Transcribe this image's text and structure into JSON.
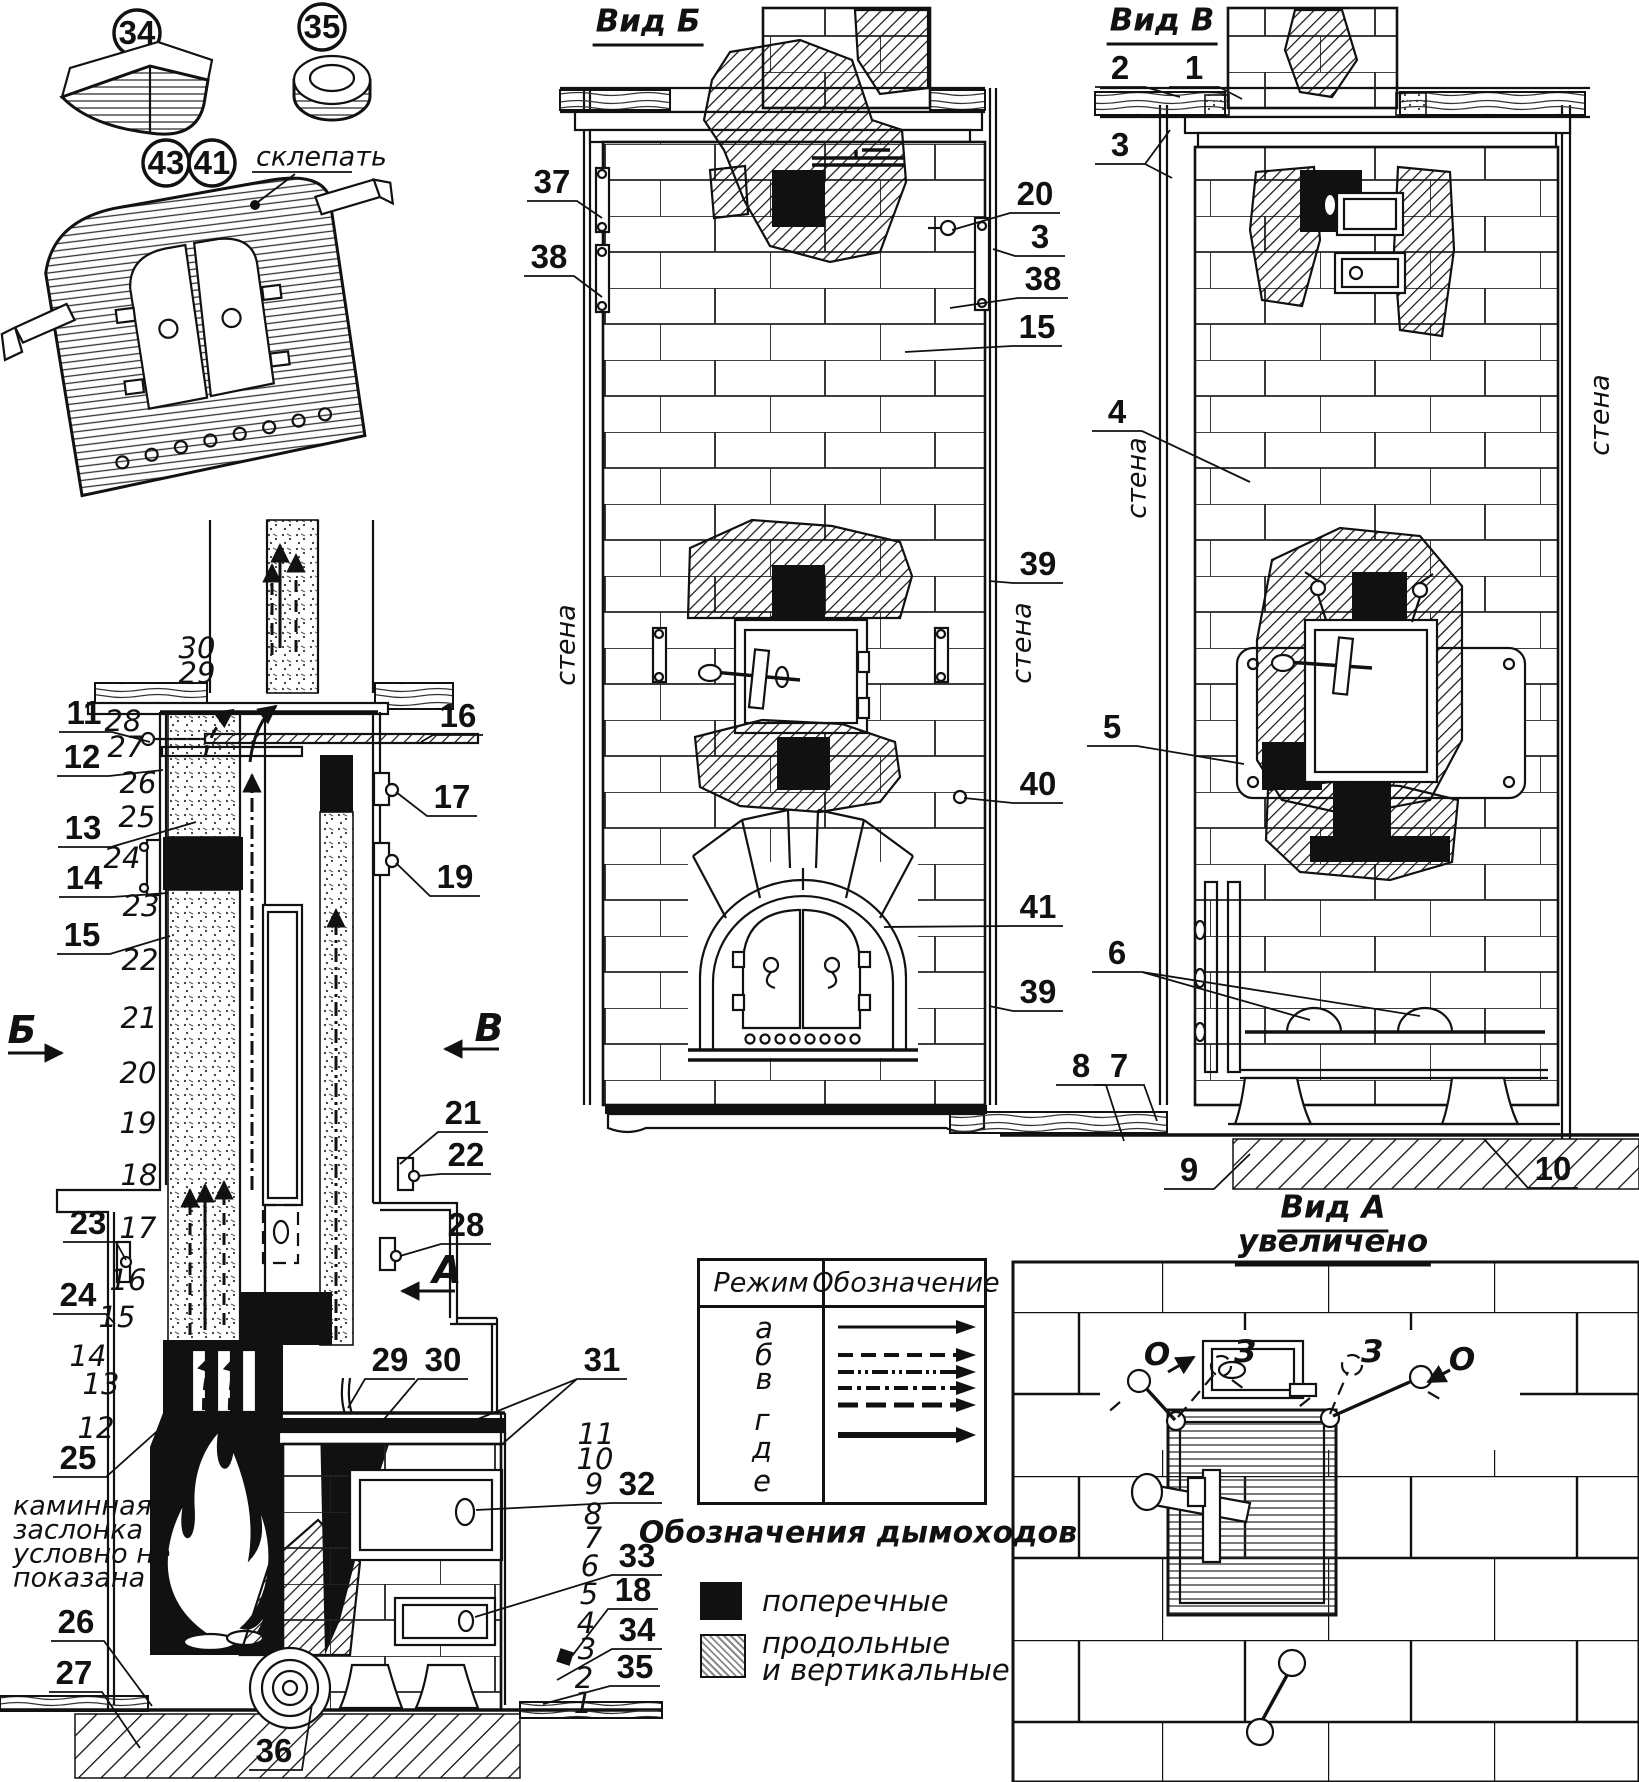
{
  "parts_detail": {
    "circle_34": "34",
    "circle_35": "35",
    "circle_43": "43",
    "circle_41": "41",
    "rivet_label": "склепать"
  },
  "section": {
    "dir_b": "Б",
    "dir_v": "В",
    "dir_a": "А",
    "note_line1": "каминная",
    "note_line2": "заслонка",
    "note_line3": "условно не",
    "note_line4": "показана",
    "rows_left": [
      "30",
      "29",
      "28",
      "27",
      "26",
      "25",
      "24",
      "23",
      "22",
      "21",
      "20",
      "19",
      "18",
      "17",
      "16",
      "15",
      "14",
      "13",
      "12"
    ],
    "rows_right": [
      "11",
      "10",
      "9",
      "8",
      "7",
      "6",
      "5",
      "4",
      "3",
      "2",
      "1"
    ],
    "callouts_left": [
      "11",
      "12",
      "13",
      "14",
      "15",
      "23",
      "24",
      "25",
      "26",
      "27"
    ],
    "callouts_right": [
      "16",
      "17",
      "19",
      "21",
      "22",
      "28",
      "29",
      "30",
      "31",
      "32",
      "33",
      "18",
      "34",
      "35"
    ],
    "callout_36": "36"
  },
  "vid_b": {
    "title": "Вид Б",
    "wall_left": "стена",
    "wall_right": "стена",
    "callouts_left": [
      "37",
      "38"
    ],
    "callouts_right": [
      "20",
      "3",
      "38",
      "15",
      "39",
      "40",
      "41",
      "39"
    ]
  },
  "vid_v": {
    "title": "Вид В",
    "wall_left": "стена",
    "wall_right": "стена",
    "callouts": [
      "2",
      "1",
      "3",
      "4",
      "5",
      "6",
      "8",
      "7",
      "9",
      "10"
    ]
  },
  "vid_a": {
    "title": "Вид А",
    "subtitle": "увеличено",
    "open_left": "О",
    "closed_left": "З",
    "closed_right": "З",
    "open_right": "О"
  },
  "legend_table": {
    "header_mode": "Режим",
    "header_symbol": "Обозначение",
    "rows": [
      {
        "mode": "а",
        "styles": [
          "solid"
        ]
      },
      {
        "mode": "б",
        "styles": [
          "dashed"
        ]
      },
      {
        "mode": "в",
        "styles": [
          "dash-dot-dot",
          "dash-dot"
        ]
      },
      {
        "mode": "г",
        "styles": [
          "long-dash"
        ]
      },
      {
        "mode": "д",
        "styles": [
          "thick-solid"
        ]
      },
      {
        "mode": "е",
        "styles": []
      }
    ]
  },
  "flue_legend": {
    "title": "Обозначения дымоходов",
    "transverse": "поперечные",
    "longitudinal_1": "продольные",
    "longitudinal_2": "и вертикальные"
  }
}
